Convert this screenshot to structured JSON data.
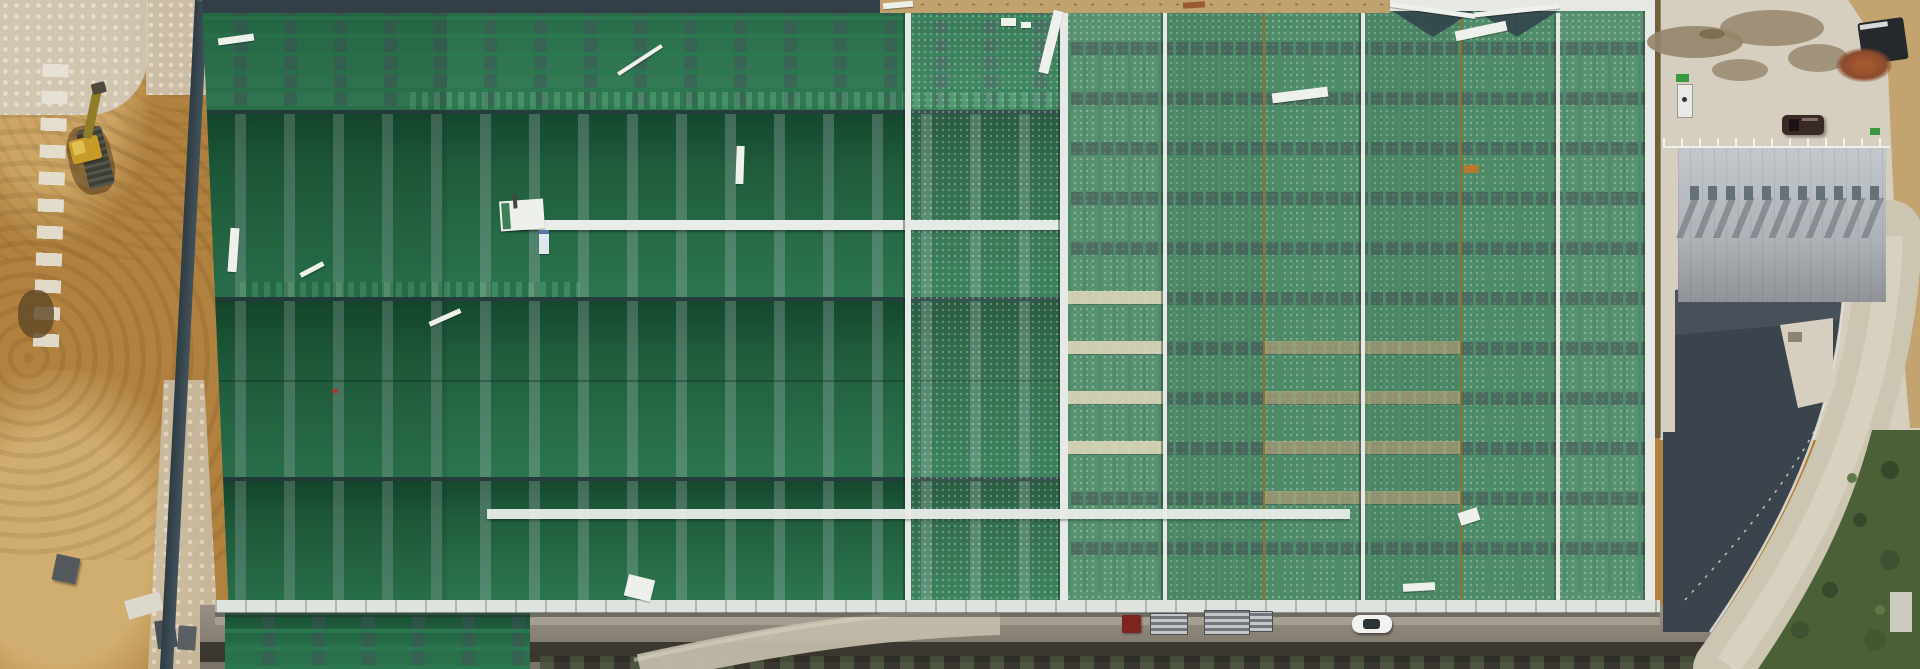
{
  "scene": {
    "type": "aerial drone photograph",
    "view": "nadir (straight-down) view",
    "description": "Top-down aerial photo of a very large industrial warehouse with a green metal roof under construction. A graded brown-earth construction area with a yellow excavator borders the left side. The roof has two blocks: a west block of long monitor slopes with dashed skylight strips running north-south, and an east block with skylight rows running east-west and white ridge caps. To the right are a concrete staging yard with damp patches, a smaller building with a light gray vented gable roof, a dark slate lower roof, and a curved concrete perimeter road with trees outside the curve. A dirt service road with parked vehicles and pallet stacks runs along the south eave.",
    "lighting": "bright daylight, shadows cast toward lower-left"
  },
  "palette": {
    "dirt": "#b0813f",
    "dirt_light": "#cfa968",
    "dirt_strip": "#c3a471",
    "rubble": "#d3cdbf",
    "roof_left_green": "#2c7850",
    "roof_right_green": "#4e8c69",
    "ridge_white": "#e9ece9",
    "fascia_dark": "#333f47",
    "gutter_white": "#dfe3de",
    "concrete_yard": "#d6cfc0",
    "wet_stain": "#95856a",
    "gray_roof": "#b7bcc1",
    "slate_dark": "#3b434d",
    "road_concrete": "#ccc5b2",
    "ground_road": "#8a8274",
    "ditch_dark": "#35322b",
    "vegetation": "#4b6036",
    "debris_white": "#eef0ec",
    "seam_orange": "#b9762e"
  },
  "regions": {
    "construction_dirt_area": {
      "label": "graded earth construction zone with machine track marks",
      "position": "left edge"
    },
    "warehouse_roof_west": {
      "label": "green roof, west block: monitor slopes with north-south dashed skylight strips",
      "slope_bands": 4
    },
    "warehouse_roof_east": {
      "label": "green roof, east block: east-west skylight rows, white vertical ridge caps",
      "ridge_caps": 5
    },
    "ridge_cap_strips": {
      "label": "white ridge cap / walkway strips across roof"
    },
    "eave_gutter": {
      "label": "white gutter line along south eave"
    },
    "concrete_yard": {
      "label": "concrete staging yard with damp soil stains",
      "position": "upper right"
    },
    "small_building": {
      "label": "light gray gable roof with a row of ridge vents casting shadows",
      "vent_count": 11
    },
    "slate_slope": {
      "label": "dark slate lower roof / paved slope",
      "position": "right"
    },
    "perimeter_road": {
      "label": "curved light concrete perimeter road",
      "position": "right edge"
    },
    "vegetation": {
      "label": "trees and scrub outside the road curve",
      "position": "bottom right"
    },
    "service_road": {
      "label": "dirt service road with drainage ditch along south eave"
    }
  },
  "objects": {
    "excavator": {
      "label": "yellow excavator working in the dirt",
      "color": "#c89a28"
    },
    "suv": {
      "label": "dark SUV parked in the yard",
      "color": "#3a2a26"
    },
    "white_car": {
      "label": "white car on the service road",
      "color": "#f2f3f1"
    },
    "red_container": {
      "label": "red container / truck cab",
      "color": "#7e2420"
    },
    "pallet_stacks": {
      "label": "stacked roofing-material pallets",
      "count": 3
    },
    "trailer": {
      "label": "dark trailer / implement",
      "color": "#26292c"
    },
    "rust_pile": {
      "label": "pile of rusty rebar",
      "color": "#8a4a2e"
    },
    "green_bin": {
      "label": "small green bin",
      "color": "#3a9a3f"
    },
    "utility_cabinet": {
      "label": "white utility cabinet",
      "color": "#e9e9e6"
    },
    "concrete_blocks": {
      "label": "gray concrete blocks in dirt",
      "color": "#55595e"
    },
    "roof_debris": {
      "label": "loose white flashing and panel off-cuts on the roof"
    }
  }
}
